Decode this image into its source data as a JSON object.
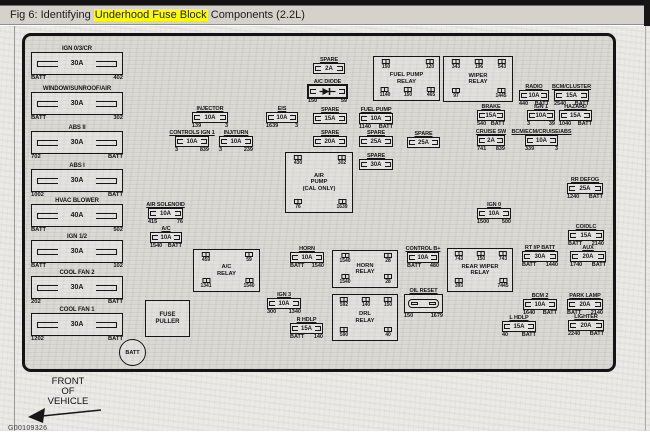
{
  "window": {
    "title_prefix": "Fig 6: Identifying ",
    "title_highlight": "Underhood Fuse Block",
    "title_suffix": " Components (2.2L)",
    "highlight_color": "#ffff00",
    "titlebar_bg": "#d5d2cb"
  },
  "diagram": {
    "front_lines": [
      "FRONT",
      "OF",
      "VEHICLE"
    ],
    "doc_code": "G00109326",
    "batt_label": "BATT",
    "fuse_puller_lines": [
      "FUSE",
      "PULLER"
    ],
    "maxi_fuses": [
      {
        "name": "IGN 0/3/CR",
        "amp": "30A",
        "ll": "BATT",
        "rl": "402",
        "x": 31,
        "y": 52
      },
      {
        "name": "WINDOW/SUNROOF/AIR",
        "amp": "30A",
        "ll": "BATT",
        "rl": "302",
        "x": 31,
        "y": 92
      },
      {
        "name": "ABS II",
        "amp": "30A",
        "ll": "702",
        "rl": "BATT",
        "x": 31,
        "y": 131
      },
      {
        "name": "ABS I",
        "amp": "30A",
        "ll": "1002",
        "rl": "BATT",
        "x": 31,
        "y": 169
      },
      {
        "name": "HVAC BLOWER",
        "amp": "40A",
        "ll": "BATT",
        "rl": "502",
        "x": 31,
        "y": 204
      },
      {
        "name": "IGN 1/2",
        "amp": "30A",
        "ll": "BATT",
        "rl": "102",
        "x": 31,
        "y": 240
      },
      {
        "name": "COOL FAN 2",
        "amp": "30A",
        "ll": "202",
        "rl": "BATT",
        "x": 31,
        "y": 276
      },
      {
        "name": "COOL FAN 1",
        "amp": "30A",
        "ll": "1202",
        "rl": "BATT",
        "x": 31,
        "y": 313
      }
    ],
    "fuses": [
      {
        "name": "INJECTOR",
        "amp": "10A",
        "ll": "139",
        "rl": "3",
        "x": 192,
        "y": 112,
        "w": 36
      },
      {
        "name": "EIS",
        "amp": "10A",
        "ll": "1639",
        "rl": "3",
        "x": 266,
        "y": 112,
        "w": 32
      },
      {
        "name": "CONTROLS IGN 1",
        "amp": "10A",
        "ll": "3",
        "rl": "839",
        "x": 175,
        "y": 136,
        "w": 34
      },
      {
        "name": "INJ/TURN",
        "amp": "10A",
        "ll": "3",
        "rl": "239",
        "x": 219,
        "y": 136,
        "w": 34
      },
      {
        "name": "SPARE",
        "amp": "2A",
        "ll": "",
        "rl": "",
        "x": 313,
        "y": 63,
        "w": 32
      },
      {
        "name": "SPARE",
        "amp": "15A",
        "ll": "",
        "rl": "",
        "x": 313,
        "y": 113,
        "w": 34
      },
      {
        "name": "FUEL PUMP",
        "amp": "10A",
        "ll": "1140",
        "rl": "BATT",
        "x": 359,
        "y": 113,
        "w": 34
      },
      {
        "name": "SPARE",
        "amp": "20A",
        "ll": "",
        "rl": "",
        "x": 313,
        "y": 136,
        "w": 34
      },
      {
        "name": "SPARE",
        "amp": "25A",
        "ll": "",
        "rl": "",
        "x": 359,
        "y": 136,
        "w": 34
      },
      {
        "name": "SPARE",
        "amp": "25A",
        "ll": "",
        "rl": "",
        "x": 407,
        "y": 137,
        "w": 33
      },
      {
        "name": "SPARE",
        "amp": "30A",
        "ll": "",
        "rl": "",
        "x": 359,
        "y": 159,
        "w": 34
      },
      {
        "name": "AIR SOLENOID",
        "amp": "10A",
        "ll": "415",
        "rl": "76",
        "x": 148,
        "y": 208,
        "w": 35
      },
      {
        "name": "A/C",
        "amp": "10A",
        "ll": "1540",
        "rl": "BATT",
        "x": 150,
        "y": 232,
        "w": 32
      },
      {
        "name": "HORN",
        "amp": "10A",
        "ll": "BATT",
        "rl": "1540",
        "x": 290,
        "y": 252,
        "w": 34
      },
      {
        "name": "CONTROL B+",
        "amp": "10A",
        "ll": "BATT",
        "rl": "480",
        "x": 407,
        "y": 252,
        "w": 32
      },
      {
        "name": "IGN 3",
        "amp": "10A",
        "ll": "300",
        "rl": "1340",
        "x": 267,
        "y": 298,
        "w": 34
      },
      {
        "name": "R HDLP",
        "amp": "15A",
        "ll": "BATT",
        "rl": "140",
        "x": 290,
        "y": 323,
        "w": 33
      },
      {
        "name": "RADIO",
        "amp": "10A",
        "ll": "440",
        "rl": "BATT",
        "x": 519,
        "y": 90,
        "w": 30
      },
      {
        "name": "BCM/CLUSTER",
        "amp": "15A",
        "ll": "2540",
        "rl": "BATT",
        "x": 554,
        "y": 90,
        "w": 35
      },
      {
        "name": "BRAKE",
        "amp": "15A",
        "ll": "540",
        "rl": "BATT",
        "x": 477,
        "y": 110,
        "w": 28
      },
      {
        "name": "IGN 1",
        "amp": "10A",
        "ll": "3",
        "rl": "39",
        "x": 527,
        "y": 110,
        "w": 28
      },
      {
        "name": "HAZARD",
        "amp": "15A",
        "ll": "1040",
        "rl": "BATT",
        "x": 559,
        "y": 110,
        "w": 33
      },
      {
        "name": "CRUISE SW",
        "amp": "2A",
        "ll": "741",
        "rl": "839",
        "x": 477,
        "y": 135,
        "w": 28
      },
      {
        "name": "BCM/ECM/CRUISE/ABS",
        "amp": "10A",
        "ll": "339",
        "rl": "3",
        "x": 525,
        "y": 135,
        "w": 33
      },
      {
        "name": "RR DEFOG",
        "amp": "25A",
        "ll": "1240",
        "rl": "BATT",
        "x": 567,
        "y": 183,
        "w": 36
      },
      {
        "name": "IGN 0",
        "amp": "10A",
        "ll": "1500",
        "rl": "500",
        "x": 477,
        "y": 208,
        "w": 34
      },
      {
        "name": "CO/DLC",
        "amp": "15A",
        "ll": "BATT",
        "rl": "2140",
        "x": 568,
        "y": 230,
        "w": 36
      },
      {
        "name": "RT I/P BATT",
        "amp": "30A",
        "ll": "BATT",
        "rl": "1440",
        "x": 522,
        "y": 251,
        "w": 36
      },
      {
        "name": "AUX",
        "amp": "20A",
        "ll": "1740",
        "rl": "BATT",
        "x": 570,
        "y": 251,
        "w": 36
      },
      {
        "name": "BCM 2",
        "amp": "10A",
        "ll": "1640",
        "rl": "BATT",
        "x": 523,
        "y": 299,
        "w": 34
      },
      {
        "name": "PARK LAMP",
        "amp": "20A",
        "ll": "BATT",
        "rl": "2140",
        "x": 567,
        "y": 299,
        "w": 36
      },
      {
        "name": "L HDLP",
        "amp": "15A",
        "ll": "40",
        "rl": "BATT",
        "x": 502,
        "y": 321,
        "w": 34
      },
      {
        "name": "LIGHTER",
        "amp": "20A",
        "ll": "2240",
        "rl": "BATT",
        "x": 568,
        "y": 320,
        "w": 36
      }
    ],
    "relays": [
      {
        "name": [
          "FUEL PUMP",
          "RELAY"
        ],
        "x": 373,
        "y": 56,
        "w": 67,
        "h": 45,
        "pins": [
          {
            "t": "150",
            "cx": 12,
            "row": "top"
          },
          {
            "t": "120",
            "cx": 56,
            "row": "top"
          },
          {
            "t": "1140",
            "cx": 11,
            "row": "bot"
          },
          {
            "t": "150",
            "cx": 34,
            "row": "bot"
          },
          {
            "t": "465",
            "cx": 57,
            "row": "bot"
          }
        ]
      },
      {
        "name": [
          "WIPER",
          "RELAY"
        ],
        "x": 443,
        "y": 56,
        "w": 70,
        "h": 46,
        "pins": [
          {
            "t": "343",
            "cx": 12,
            "row": "top"
          },
          {
            "t": "196",
            "cx": 35,
            "row": "top"
          },
          {
            "t": "543",
            "cx": 58,
            "row": "top"
          },
          {
            "t": "97",
            "cx": 12,
            "row": "bot"
          },
          {
            "t": "1445",
            "cx": 57,
            "row": "bot"
          }
        ]
      },
      {
        "name": [
          "AIR",
          "PUMP",
          "(CAL ONLY)"
        ],
        "x": 285,
        "y": 152,
        "w": 68,
        "h": 61,
        "pins": [
          {
            "t": "430",
            "cx": 12,
            "row": "top"
          },
          {
            "t": "302",
            "cx": 56,
            "row": "top"
          },
          {
            "t": "76",
            "cx": 12,
            "row": "bot"
          },
          {
            "t": "1639",
            "cx": 56,
            "row": "bot"
          }
        ]
      },
      {
        "name": [
          "A/C",
          "RELAY"
        ],
        "x": 193,
        "y": 249,
        "w": 67,
        "h": 43,
        "pins": [
          {
            "t": "459",
            "cx": 12,
            "row": "top"
          },
          {
            "t": "59",
            "cx": 55,
            "row": "top"
          },
          {
            "t": "1341",
            "cx": 12,
            "row": "bot"
          },
          {
            "t": "1540",
            "cx": 55,
            "row": "bot"
          }
        ]
      },
      {
        "name": [
          "HORN",
          "RELAY"
        ],
        "x": 332,
        "y": 250,
        "w": 66,
        "h": 38,
        "pins": [
          {
            "t": "1540",
            "cx": 12,
            "row": "top"
          },
          {
            "t": "28",
            "cx": 55,
            "row": "top"
          },
          {
            "t": "1540",
            "cx": 12,
            "row": "bot"
          },
          {
            "t": "28",
            "cx": 55,
            "row": "bot"
          }
        ]
      },
      {
        "name": [
          "REAR WIPER",
          "RELAY"
        ],
        "x": 447,
        "y": 248,
        "w": 66,
        "h": 44,
        "pins": [
          {
            "t": "743",
            "cx": 11,
            "row": "top"
          },
          {
            "t": "150",
            "cx": 33,
            "row": "top"
          },
          {
            "t": "743",
            "cx": 55,
            "row": "top"
          },
          {
            "t": "393",
            "cx": 11,
            "row": "bot"
          },
          {
            "t": "7445",
            "cx": 55,
            "row": "bot"
          }
        ]
      },
      {
        "name": [
          "DRL",
          "RELAY"
        ],
        "x": 332,
        "y": 294,
        "w": 66,
        "h": 47,
        "pins": [
          {
            "t": "592",
            "cx": 11,
            "row": "top"
          },
          {
            "t": "140",
            "cx": 33,
            "row": "top"
          },
          {
            "t": "150",
            "cx": 55,
            "row": "top"
          },
          {
            "t": "590",
            "cx": 11,
            "row": "bot"
          },
          {
            "t": "40",
            "cx": 55,
            "row": "bot"
          }
        ]
      }
    ],
    "diode": {
      "name": "A/C DIODE",
      "ll": "150",
      "rl": "59"
    },
    "oil_reset": {
      "name": "OIL RESET",
      "ll": "150",
      "rl": "1679"
    }
  }
}
